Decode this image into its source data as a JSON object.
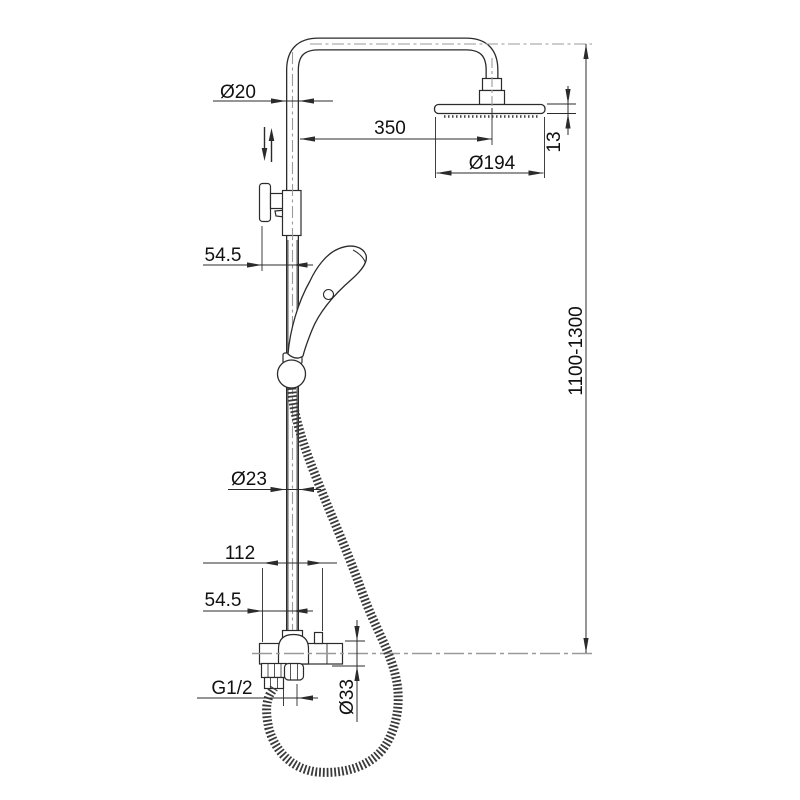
{
  "drawing": {
    "subject": "shower-column-technical-drawing",
    "style": {
      "line_color": "#2b2b2b",
      "centerline_color": "#9a9a9a",
      "background": "#ffffff"
    },
    "dimensions": {
      "riser_diameter": "Ø20",
      "arm_reach": "350",
      "head_diameter": "Ø194",
      "head_thickness": "13",
      "height_range": "1100-1300",
      "wall_offset_upper": "54.5",
      "column_diameter": "Ø23",
      "mixer_depth": "112",
      "wall_offset_lower": "54.5",
      "hose_thread": "G1/2",
      "mixer_body_diameter": "Ø33"
    }
  }
}
